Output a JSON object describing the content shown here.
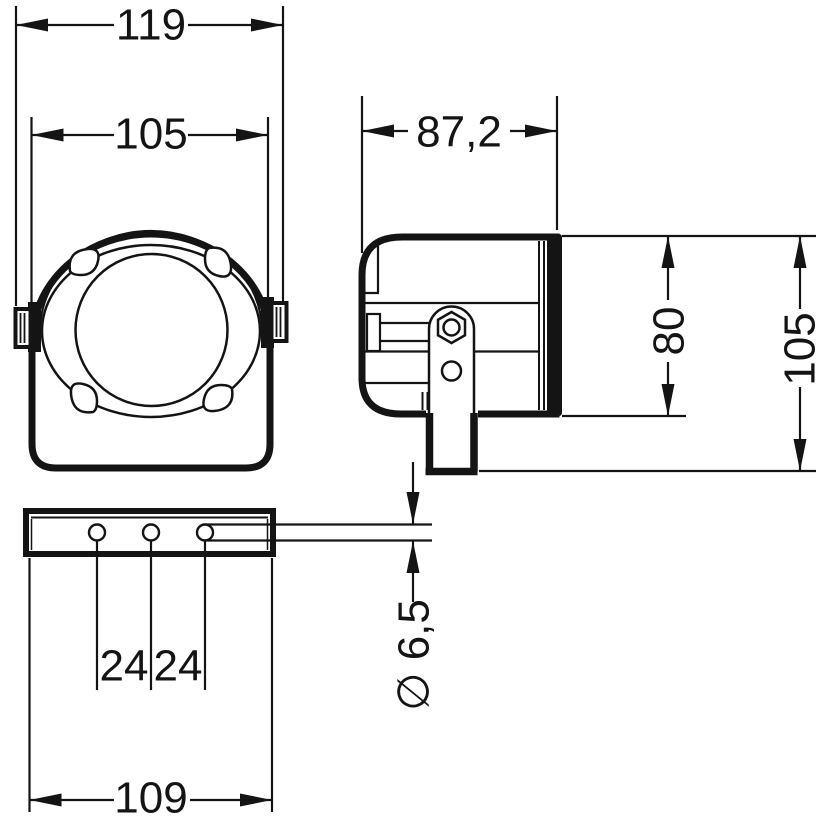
{
  "drawing": {
    "type": "technical-dimension-drawing",
    "views": {
      "front_view": "front view of device with round speaker face and side mounting tabs",
      "side_view": "side view with mounting bracket, hex nut and bracket leg",
      "plate_view": "bottom mounting plate with three holes"
    },
    "colors": {
      "line": "#141414",
      "background": "#ffffff"
    },
    "dimensions": {
      "overall_width": "119",
      "body_width": "105",
      "depth": "87,2",
      "body_height": "80",
      "overall_height": "105",
      "hole_pitch_left": "24",
      "hole_pitch_right": "24",
      "plate_length": "109",
      "hole_diameter": "∅ 6,5"
    }
  }
}
